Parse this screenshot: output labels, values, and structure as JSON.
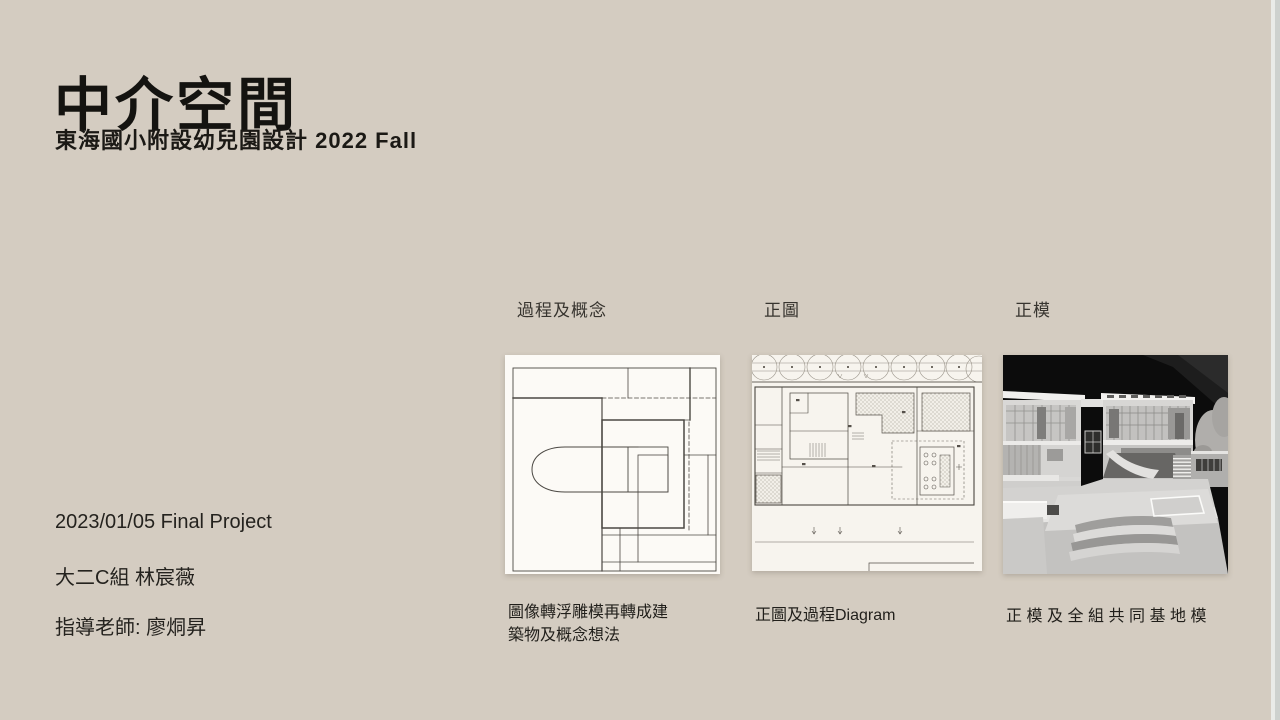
{
  "slide": {
    "title": "中介空間",
    "subtitle": "東海國小附設幼兒園設計 2022 Fall",
    "info_lines": [
      "2023/01/05 Final Project",
      "大二C組 林宸薇",
      "指導老師: 廖烔昇"
    ],
    "columns": [
      {
        "heading": "過程及概念",
        "caption": "圖像轉浮雕模再轉成建築物及概念想法",
        "image": "concept-sketch"
      },
      {
        "heading": "正圖",
        "caption": "正圖及過程Diagram",
        "image": "site-plan-drawing"
      },
      {
        "heading": "正模",
        "caption": "正模及全組共同基地模",
        "image": "model-photograph"
      }
    ],
    "colors": {
      "background": "#d4ccc1",
      "text_primary": "#141310",
      "sketch_paper": "#fcfaf6",
      "plan_paper": "#f7f4ee",
      "photo_background": "#0c0c0c"
    }
  }
}
